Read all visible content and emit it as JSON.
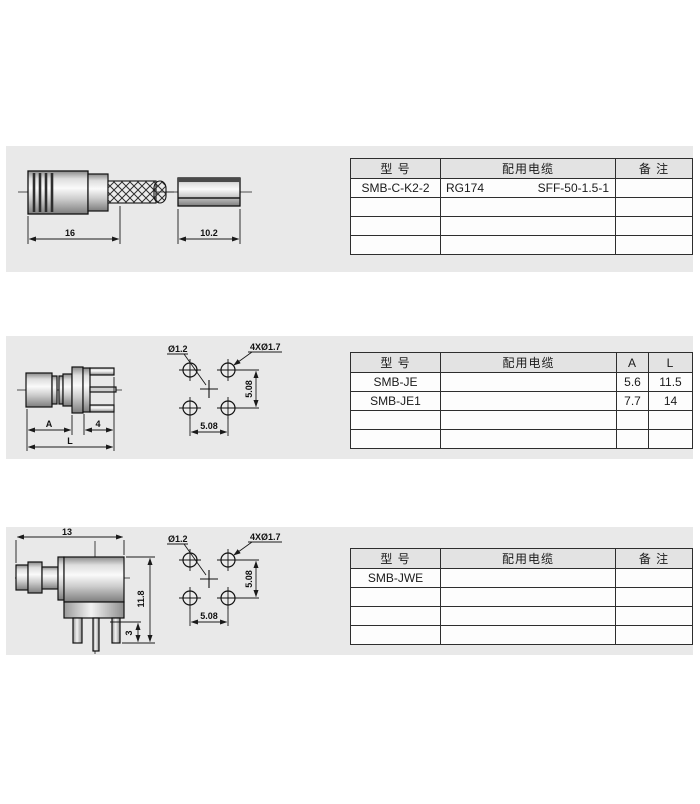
{
  "colors": {
    "page_bg": "#ffffff",
    "band_bg": "#e9e9e9",
    "table_header_bg": "#e3e3e3",
    "table_cell_bg": "#fdfdfd",
    "border": "#2e2e2e",
    "line": "#1a1a1a"
  },
  "sections": {
    "s1": {
      "drawing": {
        "dim_body_length": "16",
        "dim_ferrule_length": "10.2"
      },
      "table": {
        "header": {
          "model": "型  号",
          "cable": "配用电缆",
          "note": "备  注"
        },
        "row1": {
          "model": "SMB-C-K2-2",
          "cable_left": "RG174",
          "cable_right": "SFF-50-1.5-1",
          "note": ""
        }
      }
    },
    "s2": {
      "drawing": {
        "dim_a": "A",
        "dim_4": "4",
        "dim_l": "L"
      },
      "footprint": {
        "center_hole": "Ø1.2",
        "corner_holes": "4XØ1.7",
        "pitch_v": "5.08",
        "pitch_h": "5.08"
      },
      "table": {
        "header": {
          "model": "型  号",
          "cable": "配用电缆",
          "a": "A",
          "l": "L"
        },
        "row1": {
          "model": "SMB-JE",
          "cable": "",
          "a": "5.6",
          "l": "11.5"
        },
        "row2": {
          "model": "SMB-JE1",
          "cable": "",
          "a": "7.7",
          "l": "14"
        }
      }
    },
    "s3": {
      "drawing": {
        "dim_width": "13",
        "dim_height": "11.8",
        "dim_leg": "3"
      },
      "footprint": {
        "center_hole": "Ø1.2",
        "corner_holes": "4XØ1.7",
        "pitch_v": "5.08",
        "pitch_h": "5.08"
      },
      "table": {
        "header": {
          "model": "型  号",
          "cable": "配用电缆",
          "note": "备  注"
        },
        "row1": {
          "model": "SMB-JWE",
          "cable": "",
          "note": ""
        }
      }
    }
  }
}
